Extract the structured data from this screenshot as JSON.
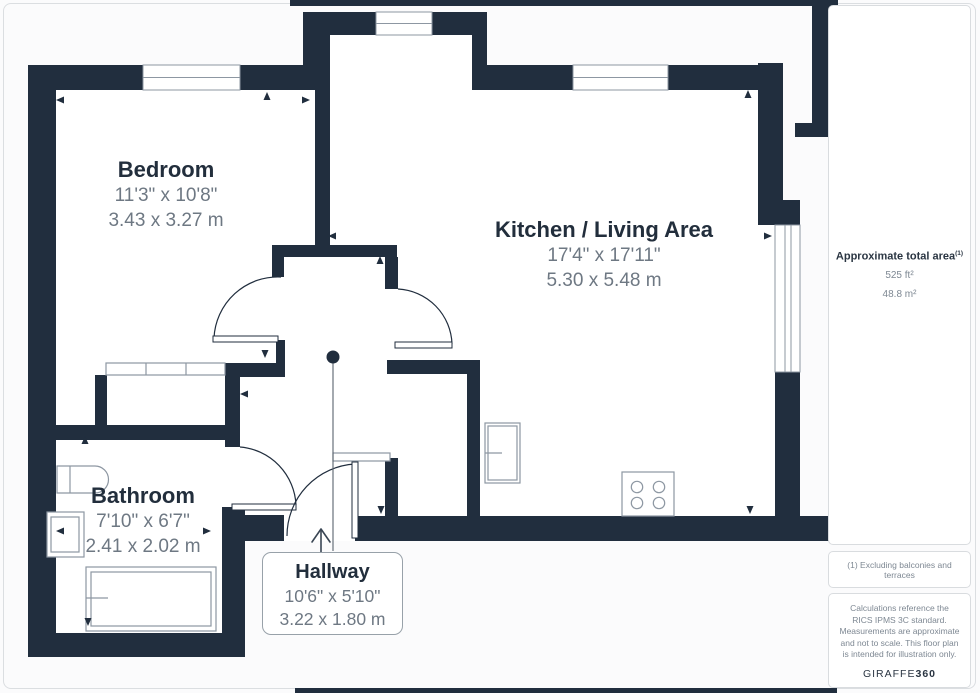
{
  "rooms": [
    {
      "name": "Bedroom",
      "imperial": "11'3\" x 10'8\"",
      "metric": "3.43 x 3.27 m"
    },
    {
      "name": "Kitchen / Living Area",
      "imperial": "17'4\" x 17'11\"",
      "metric": "5.30 x 5.48 m"
    },
    {
      "name": "Bathroom",
      "imperial": "7'10\" x 6'7\"",
      "metric": "2.41 x 2.02 m"
    },
    {
      "name": "Hallway",
      "imperial": "10'6\" x 5'10\"",
      "metric": "3.22 x 1.80 m"
    }
  ],
  "sidebar": {
    "area_title": "Approximate total area",
    "area_note_marker": "(1)",
    "area_imperial": "525 ft²",
    "area_metric": "48.8 m²",
    "footnote": "(1) Excluding balconies and terraces",
    "disclaimer": "Calculations reference the RICS IPMS 3C standard. Measurements are approximate and not to scale. This floor plan is intended for illustration only.",
    "logo_primary": "GIRAFFE",
    "logo_secondary": "360"
  },
  "colors": {
    "wall": "#212e3e",
    "room_name_text": "#222e3c",
    "dimension_text": "#6e7883",
    "fixture_stroke": "#8d97a2",
    "page_border": "#dbdee1"
  }
}
